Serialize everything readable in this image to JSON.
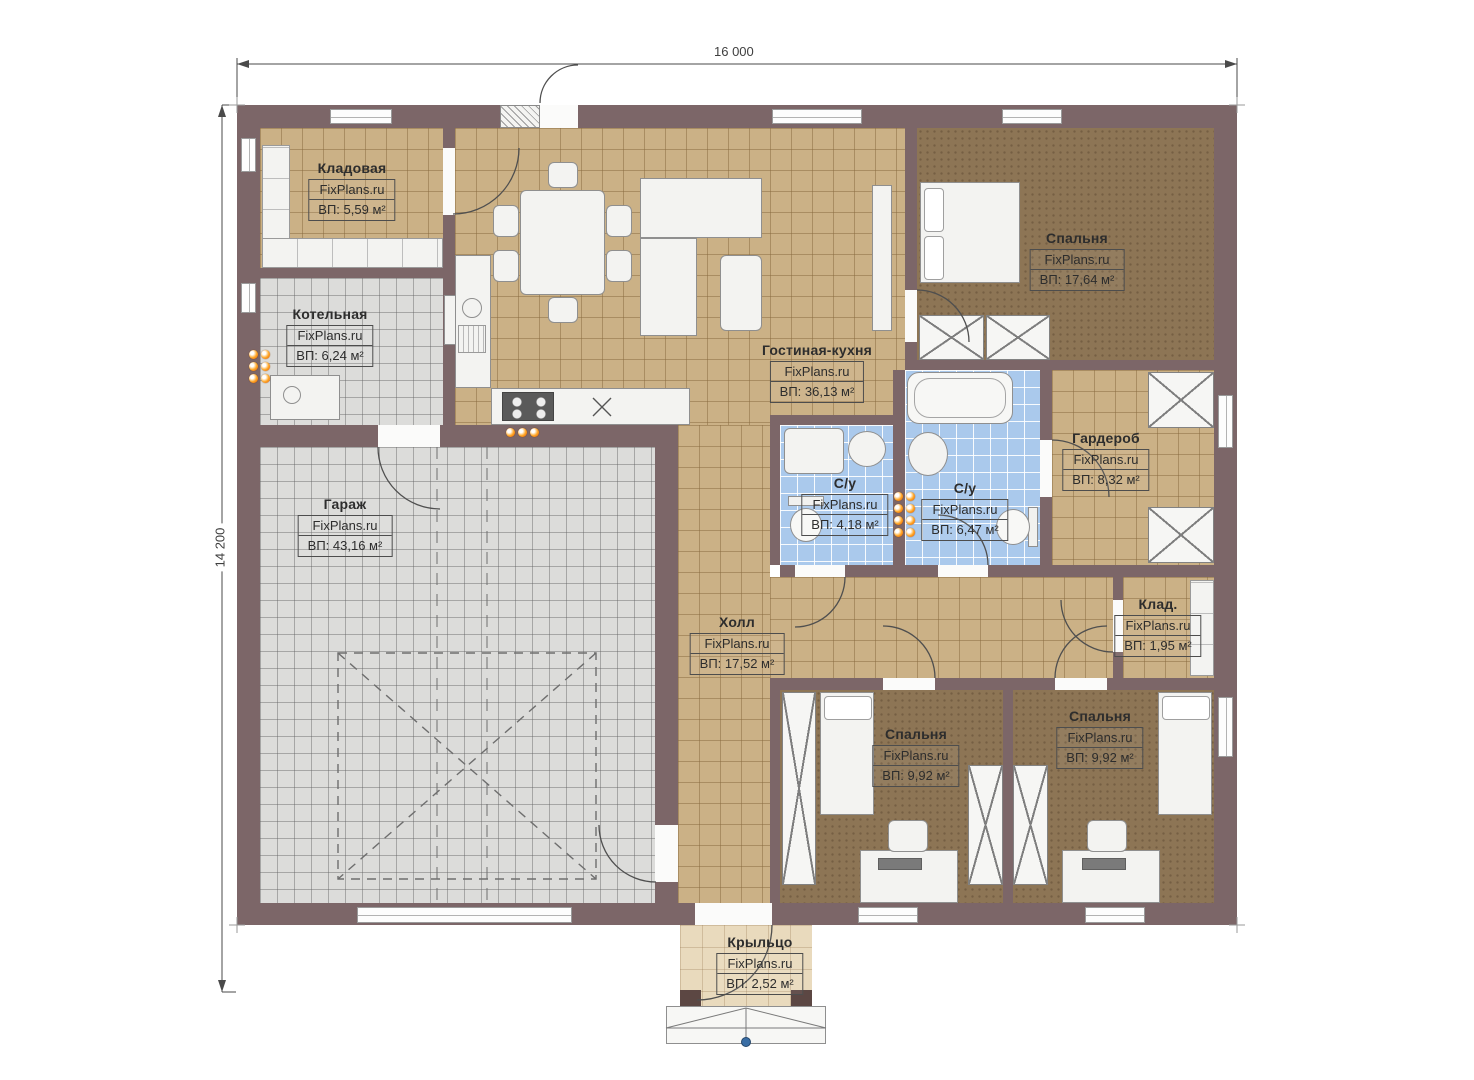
{
  "dimensions": {
    "width_label": "16 000",
    "height_label": "14 200"
  },
  "branding": {
    "watermark": "FixPlans.ru"
  },
  "rooms": [
    {
      "key": "storage",
      "name": "Кладовая",
      "area": "ВП: 5,59 м²"
    },
    {
      "key": "boiler",
      "name": "Котельная",
      "area": "ВП: 6,24 м²"
    },
    {
      "key": "garage",
      "name": "Гараж",
      "area": "ВП: 43,16 м²"
    },
    {
      "key": "living_kitchen",
      "name": "Гостиная-кухня",
      "area": "ВП: 36,13 м²"
    },
    {
      "key": "bedroom_master",
      "name": "Спальня",
      "area": "ВП: 17,64 м²"
    },
    {
      "key": "wardrobe",
      "name": "Гардероб",
      "area": "ВП: 8,32 м²"
    },
    {
      "key": "bath_small",
      "name": "С/у",
      "area": "ВП: 4,18 м²"
    },
    {
      "key": "bath_big",
      "name": "С/у",
      "area": "ВП: 6,47 м²"
    },
    {
      "key": "hall",
      "name": "Холл",
      "area": "ВП: 17,52 м²"
    },
    {
      "key": "pantry",
      "name": "Клад.",
      "area": "ВП: 1,95 м²"
    },
    {
      "key": "bedroom_left",
      "name": "Спальня",
      "area": "ВП: 9,92 м²"
    },
    {
      "key": "bedroom_right",
      "name": "Спальня",
      "area": "ВП: 9,92 м²"
    },
    {
      "key": "porch",
      "name": "Крыльцо",
      "area": "ВП: 2,52 м²"
    }
  ],
  "colors": {
    "wall": "#7c6668",
    "floor_tan": "#cbb186",
    "floor_gray": "#dcdcda",
    "floor_blue": "#aac9ec",
    "floor_brown": "#8d7555",
    "floor_porch": "#e9dabd",
    "radiator_orange": "#e65100",
    "marker_blue": "#3a6ea5"
  }
}
